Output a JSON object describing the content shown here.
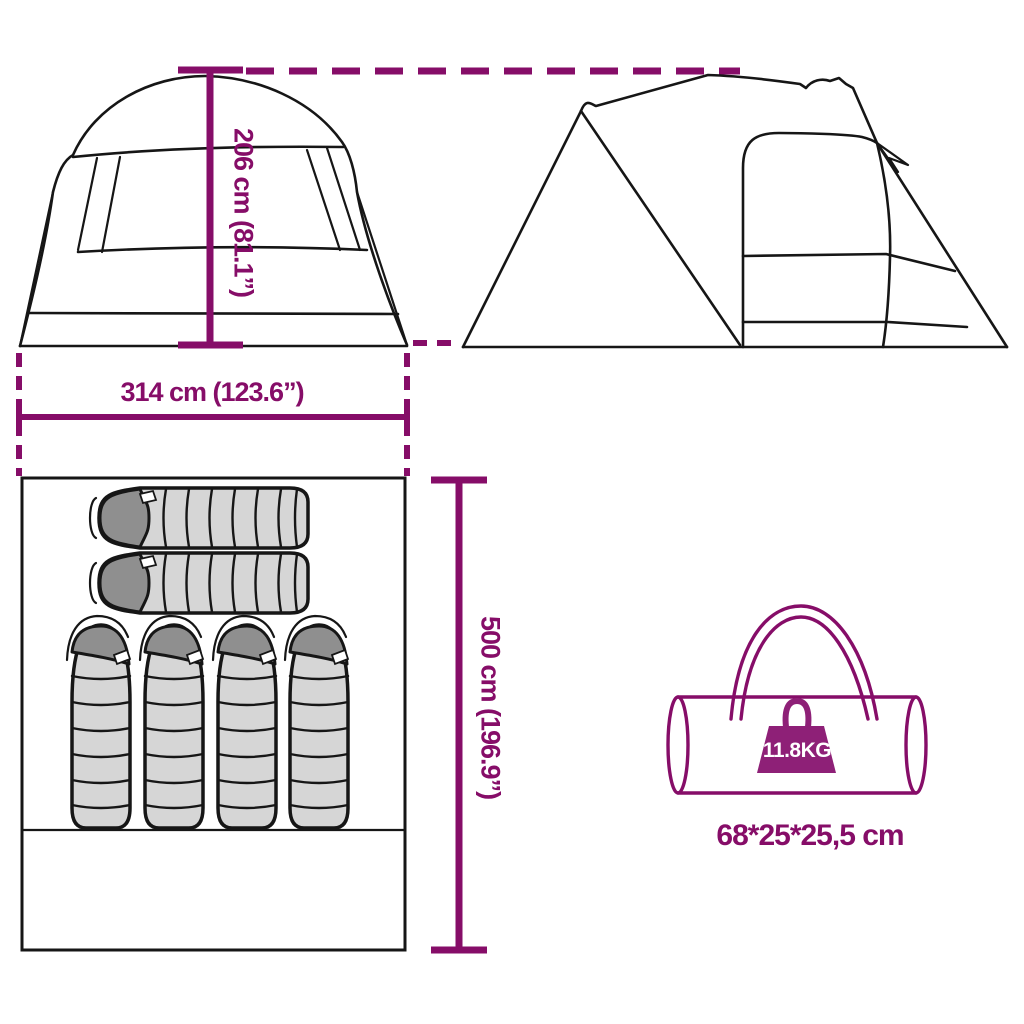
{
  "colors": {
    "accent": "#860D68",
    "weight_badge": "#8E2077",
    "line": "#161616",
    "bag_body": "#d6d6d6",
    "bag_hood": "#8f8f8f"
  },
  "labels": {
    "tent_height": "206 cm (81.1”)",
    "tent_width": "314 cm (123.6”)",
    "tent_length": "500 cm (196.9”)",
    "package_size": "68*25*25,5 cm",
    "package_weight": "11.8KG"
  },
  "illustrations": {
    "front_view": "tent-front-view",
    "side_view": "tent-side-view",
    "floor_plan": "tent-floor-plan-with-sleeping-bags",
    "sleeping_bags_horizontal": 2,
    "sleeping_bags_vertical": 4,
    "carry_bag": "carry-bag-icon",
    "weight": "weight-icon"
  }
}
